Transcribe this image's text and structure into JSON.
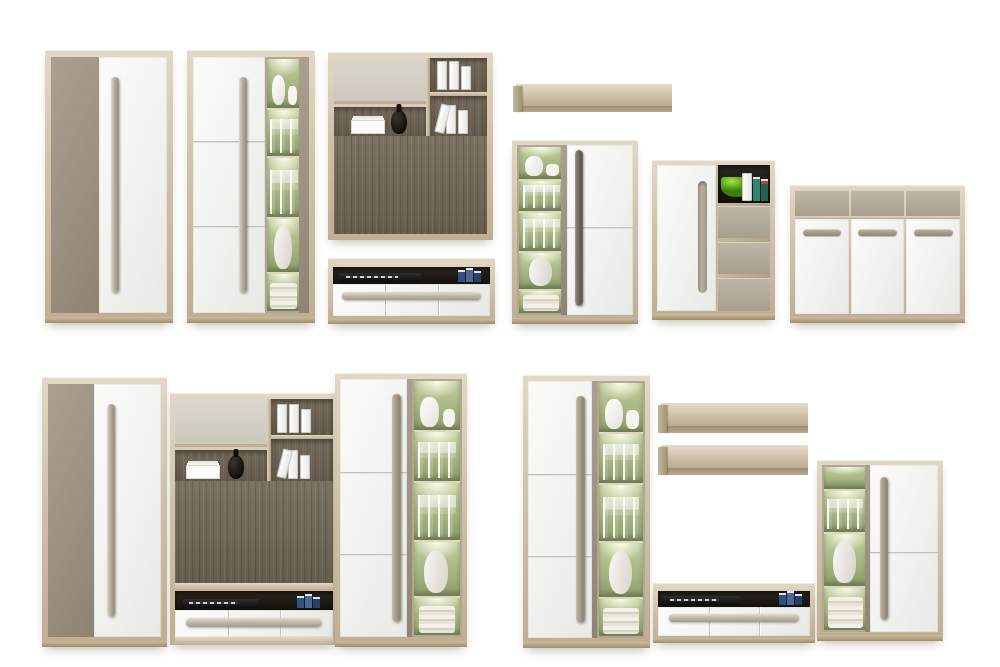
{
  "scene": {
    "title": "Modular living-room furniture collection — white and taupe fronts with light oak frames",
    "background_color": "#ffffff",
    "groups": {
      "top_row": [
        "wardrobe_a",
        "display_cabinet_a",
        "wall_unit_a",
        "tv_stand_a",
        "wall_shelf_a",
        "vitrine_cabinet_a",
        "drawer_cabinet_a",
        "sideboard_a"
      ],
      "bottom_left_set": [
        "wardrobe_b",
        "wall_unit_b",
        "tall_vitrine_b"
      ],
      "bottom_right_set": [
        "tall_vitrine_c",
        "wall_shelf_b",
        "wall_shelf_c",
        "tv_bench_b",
        "vitrine_cabinet_b"
      ]
    }
  },
  "palette": {
    "frame_wood": "#cfc1ab",
    "frame_wood_dark": "#b1a086",
    "dark_wood_panel": "#6e6456",
    "taupe_front": "#9c9080",
    "taupe_drawer": "#b2a99b",
    "white_front": "#f4f4f1",
    "flap_gray": "#d5cfc6",
    "vitrine_green": "#a9b884",
    "vitrine_glow": "#f7fae4",
    "handle_metal": "#b5ad9e",
    "handle_dark": "#6b695f",
    "compartment_black": "#1a1710",
    "accent_bowl_green": "#5ca717",
    "accent_books_blue": "#3a5a8c"
  },
  "pieces": {
    "wardrobe_a": {
      "label": "Two-door wardrobe, taupe and white fronts with long metal handle"
    },
    "display_cabinet_a": {
      "label": "Tall cabinet: three-panel white door and lit glass vitrine"
    },
    "wall_unit_a": {
      "label": "Hanging wall unit: gray flap, open shelves with binders, dark oak TV panel"
    },
    "tv_stand_a": {
      "label": "TV stand: open media shelf and three drawers with long handle"
    },
    "wall_shelf_a": {
      "label": "Floating oak wall shelf"
    },
    "vitrine_cabinet_a": {
      "label": "Display cabinet: lit glass vitrine left, white door right"
    },
    "drawer_cabinet_a": {
      "label": "Highboard: white door, open shelf with green bowl, three taupe drawers"
    },
    "sideboard_a": {
      "label": "Sideboard: three taupe top drawers and three white doors"
    },
    "wardrobe_b": {
      "label": "Two-door wardrobe, taupe and white fronts with long metal handle"
    },
    "wall_unit_b": {
      "label": "Wall unit column: flap, open shelves, dark oak panel and TV bench with drawers"
    },
    "tall_vitrine_b": {
      "label": "Tall display cabinet: white three-panel door and lit glass vitrine"
    },
    "tall_vitrine_c": {
      "label": "Tall display cabinet: white three-panel door and lit glass vitrine"
    },
    "wall_shelf_b": {
      "label": "Floating oak wall shelf"
    },
    "wall_shelf_c": {
      "label": "Floating oak wall shelf"
    },
    "tv_bench_b": {
      "label": "TV bench: open media shelf and three drawers with long handle"
    },
    "vitrine_cabinet_b": {
      "label": "Display cabinet: lit glass vitrine left, white door right"
    }
  },
  "decor_items": {
    "vitrine_contents": [
      "white jug and cups",
      "wine glasses",
      "champagne flutes",
      "white vase",
      "folded textiles"
    ],
    "shelf_items": [
      "white office binders",
      "stack of white cards",
      "black round vase"
    ],
    "media_items": [
      "black DVD player",
      "blue books"
    ],
    "accent_items": [
      "green fruit bowl",
      "books with teal spines"
    ]
  }
}
